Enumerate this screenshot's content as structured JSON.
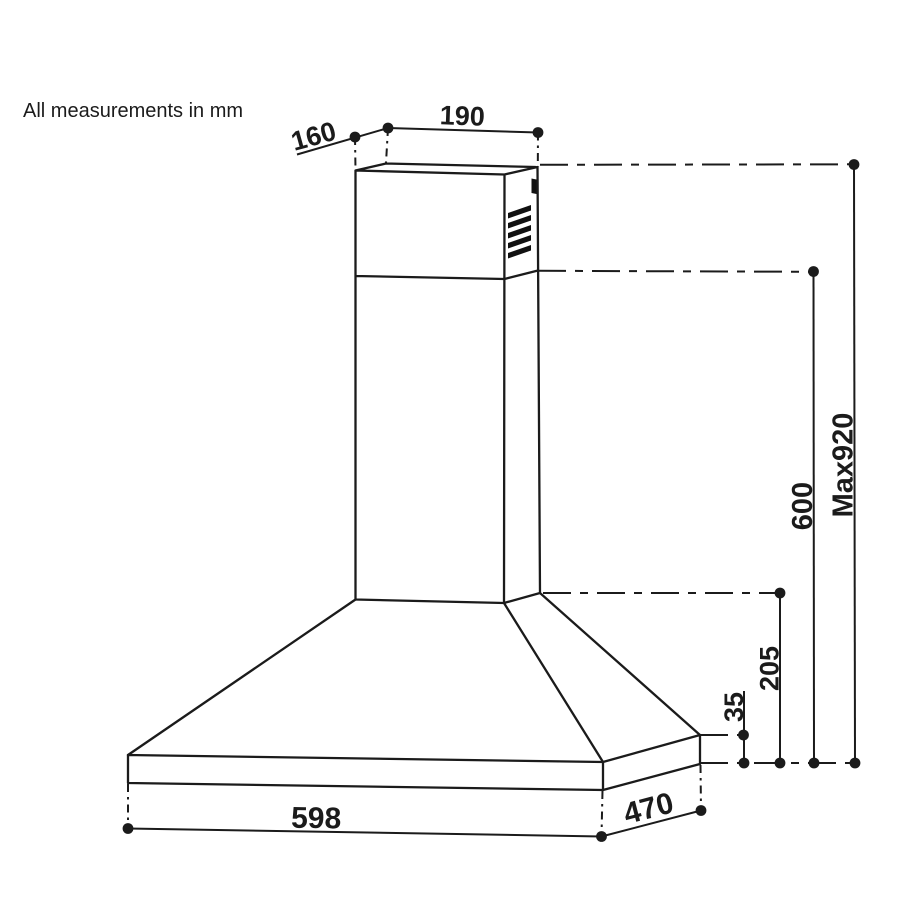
{
  "note": "All measurements in mm",
  "diagram": {
    "subject": "chimney cooker hood dimension drawing",
    "units": "mm"
  },
  "colors": {
    "line": "#1b1b1b",
    "background": "#ffffff"
  },
  "dimensions": {
    "top_outlet_depth": {
      "label": "160"
    },
    "top_outlet_width": {
      "label": "190"
    },
    "base_band_height": {
      "label": "35"
    },
    "canopy_height": {
      "label": "205"
    },
    "chimney_height": {
      "label": "600"
    },
    "max_height": {
      "label": "Max920"
    },
    "hood_width": {
      "label": "598"
    },
    "hood_depth": {
      "label": "470"
    }
  }
}
